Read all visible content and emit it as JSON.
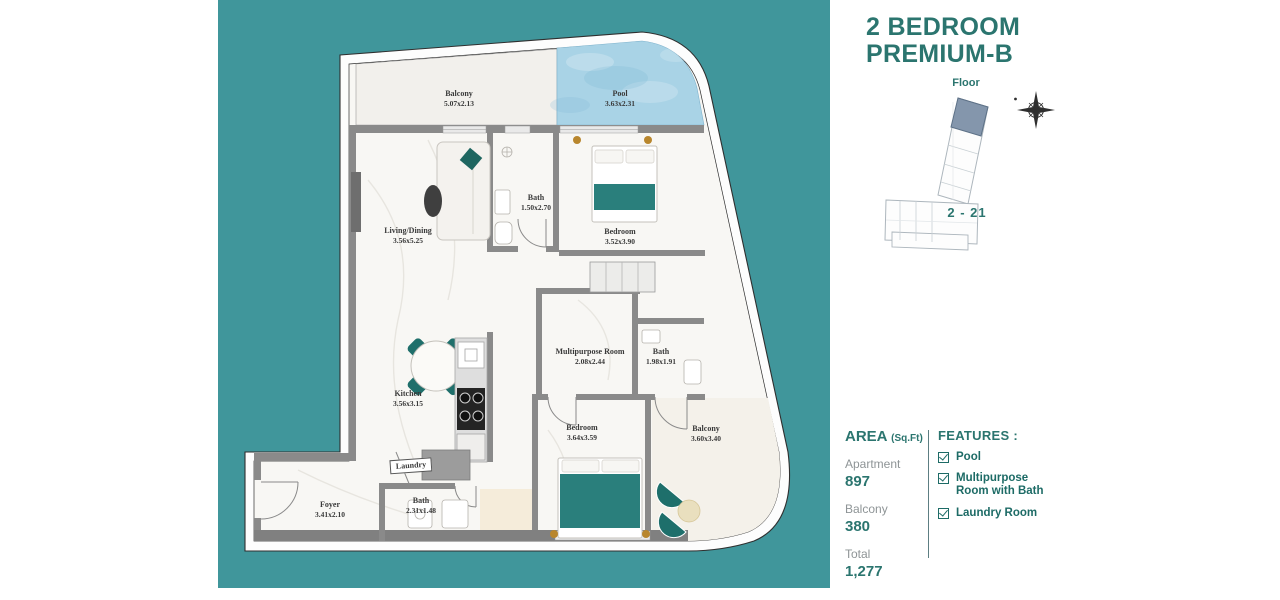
{
  "header": {
    "title_line1": "2 BEDROOM",
    "title_line2": "PREMIUM-B"
  },
  "locator": {
    "floor_label": "Floor",
    "floor_range": "2 - 21"
  },
  "area": {
    "heading": "AREA",
    "unit": "(Sq.Ft)",
    "items": [
      {
        "label": "Apartment",
        "value": "897"
      },
      {
        "label": "Balcony",
        "value": "380"
      },
      {
        "label": "Total",
        "value": "1,277"
      }
    ]
  },
  "features": {
    "heading": "FEATURES :",
    "items": [
      {
        "label": "Pool"
      },
      {
        "label": "Multipurpose Room with Bath"
      },
      {
        "label": "Laundry Room"
      }
    ]
  },
  "plan": {
    "rooms": {
      "balcony_top": {
        "name": "Balcony",
        "dims": "5.07x2.13"
      },
      "pool": {
        "name": "Pool",
        "dims": "3.63x2.31"
      },
      "living": {
        "name": "Living/Dining",
        "dims": "3.56x5.25"
      },
      "bath1": {
        "name": "Bath",
        "dims": "1.50x2.70"
      },
      "bedroom1": {
        "name": "Bedroom",
        "dims": "3.52x3.90"
      },
      "multipurpose": {
        "name": "Multipurpose Room",
        "dims": "2.08x2.44"
      },
      "bath2": {
        "name": "Bath",
        "dims": "1.98x1.91"
      },
      "kitchen": {
        "name": "Kitchen",
        "dims": "3.56x3.15"
      },
      "bedroom2": {
        "name": "Bedroom",
        "dims": "3.64x3.59"
      },
      "balcony2": {
        "name": "Balcony",
        "dims": "3.60x3.40"
      },
      "laundry": {
        "name": "Laundry"
      },
      "foyer": {
        "name": "Foyer",
        "dims": "3.41x2.10"
      },
      "bath3": {
        "name": "Bath",
        "dims": "2.31x1.48"
      }
    }
  },
  "colors": {
    "accent_teal": "#2b756f",
    "background_teal": "#40969b",
    "pool_blue": "#a9d3e6",
    "furniture_teal": "#25716d",
    "text_gray": "#8e9496",
    "wall_gray": "#8a8a8a"
  }
}
